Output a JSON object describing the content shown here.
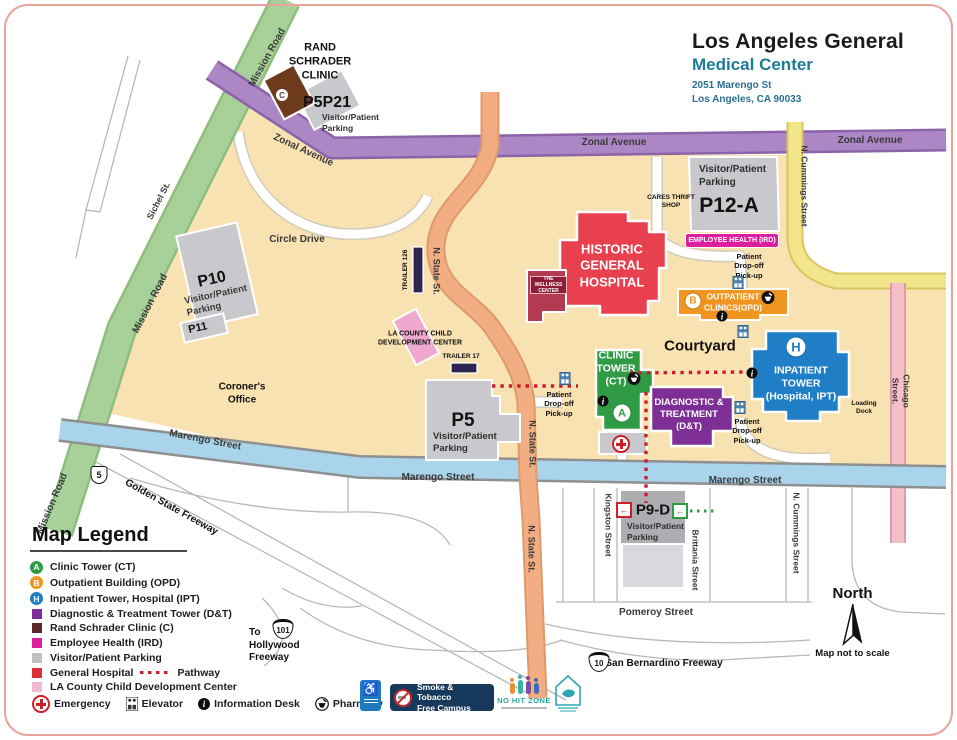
{
  "header": {
    "title": "Los Angeles General",
    "subtitle": "Medical Center",
    "address_line1": "2051 Marengo St",
    "address_line2": "Los Angeles, CA 90033"
  },
  "streets": {
    "zonal": "Zonal Avenue",
    "mission": "Mission Road",
    "sichel": "Sichel St.",
    "circle_drive": "Circle Drive",
    "n_state": "N. State St.",
    "marengo": "Marengo Street",
    "n_cummings": "N. Cummings Street",
    "chicago": "Chicago Street.",
    "kingston": "Kingston Street",
    "brittania": "Brittania Street",
    "pomeroy": "Pomeroy Street",
    "golden_state": "Golden State Freeway",
    "san_bernardino": "San Bernardino Freeway",
    "to_hollywood": "To\nHollywood\nFreeway",
    "shield_5": "5",
    "shield_101": "101",
    "shield_10": "10"
  },
  "buildings": {
    "rand_schrader": {
      "label": "RAND\nSCHRADER\nCLINIC",
      "badge": "C"
    },
    "p5p21": {
      "name": "P5P21",
      "sub": "Visitor/Patient\nParking"
    },
    "p12a": {
      "name": "P12-A",
      "sub": "Visitor/Patient\nParking"
    },
    "cares": "CARES THRIFT\nSHOP",
    "employee_health": "EMPLOYEE HEALTH (IRD)",
    "historic": "HISTORIC\nGENERAL\nHOSPITAL",
    "wellness": "THE WELLNESS\nCENTER",
    "outpatient": {
      "label": "OUTPATIENT\nCLINICS(OPD)",
      "badge": "B"
    },
    "courtyard": "Courtyard",
    "inpatient": {
      "label": "INPATIENT\nTOWER\n(Hospital, IPT)",
      "badge": "H"
    },
    "loading_dock": "Loading\nDock",
    "clinic": {
      "label": "CLINIC\nTOWER\n(CT)",
      "badge": "A"
    },
    "dt": "DIAGNOSTIC &\nTREATMENT\n(D&T)",
    "p5": {
      "name": "P5",
      "sub": "Visitor/Patient\nParking"
    },
    "p10": {
      "name": "P10",
      "sub": "Visitor/Patient\nParking"
    },
    "p11": "P11",
    "p9d": {
      "name": "P9-D",
      "sub": "Visitor/Patient\nParking"
    },
    "child_dev": "LA COUNTY CHILD\nDEVELOPMENT CENTER",
    "trailer_17": "TRAILER 17",
    "trailer_126": "TRAILER 126",
    "coroner": "Coroner's\nOffice",
    "patient_dropoff": "Patient\nDrop-off\nPick-up"
  },
  "legend": {
    "title": "Map Legend",
    "items": [
      {
        "type": "circle",
        "color": "#2F9C45",
        "letter": "A",
        "label": "Clinic Tower (CT)"
      },
      {
        "type": "circle",
        "color": "#F0951F",
        "letter": "B",
        "label": "Outpatient Building (OPD)"
      },
      {
        "type": "circle",
        "color": "#1F7EC6",
        "letter": "H",
        "label": "Inpatient Tower, Hospital (IPT)"
      },
      {
        "type": "square",
        "color": "#7E2F95",
        "label": "Diagnostic & Treatment Tower (D&T)"
      },
      {
        "type": "square",
        "color": "#5E2728",
        "label": "Rand Schrader Clinic (C)"
      },
      {
        "type": "square",
        "color": "#DC1F9E",
        "label": "Employee Health (IRD)"
      },
      {
        "type": "square",
        "color": "#C1C0C4",
        "label": "Visitor/Patient Parking"
      },
      {
        "type": "square",
        "color": "#D93038",
        "label": "General Hospital",
        "suffix": "Pathway",
        "dotted": true
      },
      {
        "type": "square",
        "color": "#F2B8D4",
        "label": "LA County Child Development Center"
      }
    ],
    "amenities": [
      {
        "label": "Emergency"
      },
      {
        "label": "Elevator"
      },
      {
        "label": "Information Desk"
      },
      {
        "label": "Pharmacy"
      }
    ]
  },
  "badges": {
    "smoke": "Smoke & Tobacco\nFree Campus",
    "no_hit": "NO HIT ZONE"
  },
  "compass": {
    "north": "North",
    "note": "Map not to scale"
  },
  "colors": {
    "campus": "#F8E2B2",
    "zonal": "#AD86C5",
    "mission": "#A8D099",
    "marengo": "#A9D4EC",
    "n_state": "#F2AE82",
    "n_cummings": "#F3E58A",
    "chicago": "#F5BFCA",
    "historic_red": "#E8404F",
    "clinic_green": "#2F9C45",
    "inpatient_blue": "#1F7EC6",
    "dt_purple": "#7E2F95",
    "outpatient_orange": "#F0951F",
    "employee_magenta": "#DC1F9E",
    "parking_gray": "#C9C8CC",
    "child_dev_pink": "#EFA9CE",
    "pathway_red": "#C81E2C"
  }
}
